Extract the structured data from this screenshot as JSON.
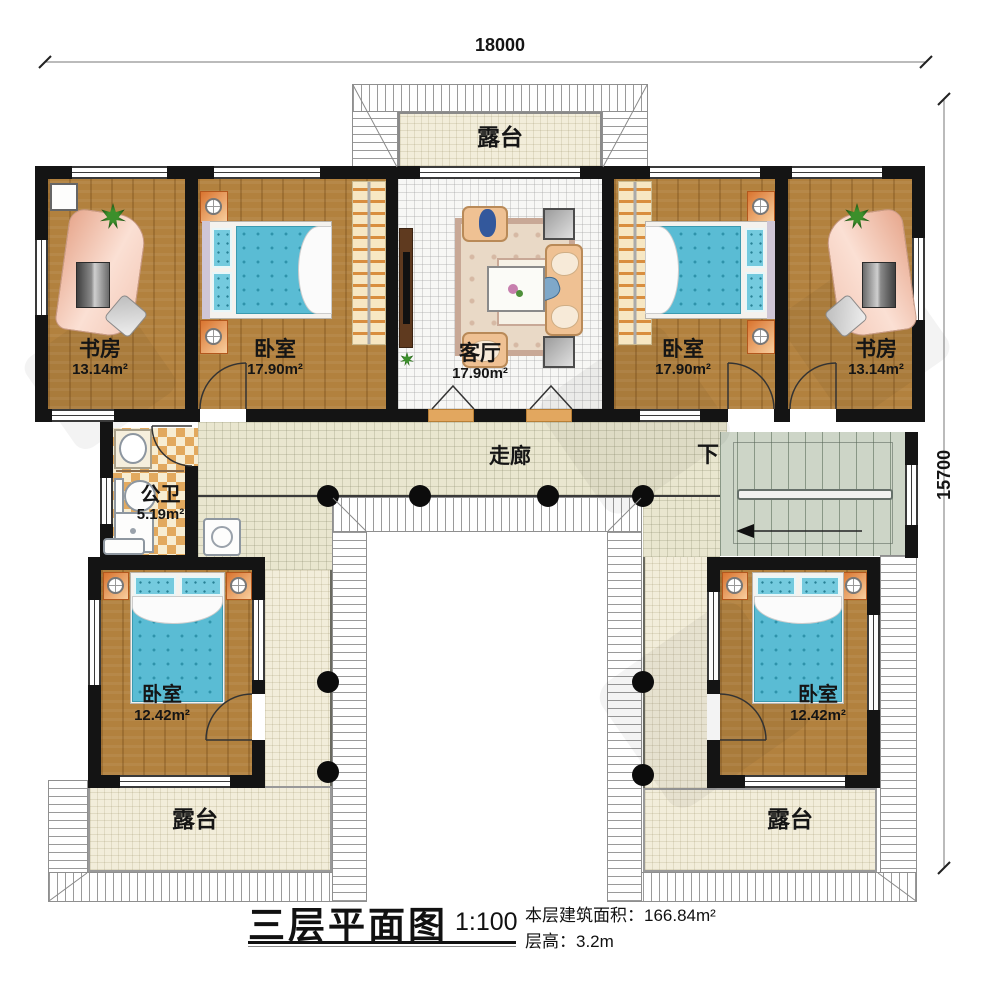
{
  "dimensions": {
    "width_label": "18000",
    "height_label": "15700"
  },
  "rooms": {
    "terrace_top": {
      "name": "露台"
    },
    "study_left": {
      "name": "书房",
      "area": "13.14m²"
    },
    "bedroom_left": {
      "name": "卧室",
      "area": "17.90m²"
    },
    "living_room": {
      "name": "客厅",
      "area": "17.90m²"
    },
    "bedroom_right": {
      "name": "卧室",
      "area": "17.90m²"
    },
    "study_right": {
      "name": "书房",
      "area": "13.14m²"
    },
    "corridor": {
      "name": "走廊"
    },
    "bathroom": {
      "name": "公卫",
      "area": "5.19m²"
    },
    "stairs": {
      "direction_label": "下"
    },
    "bedroom_bottom_left": {
      "name": "卧室",
      "area": "12.42m²"
    },
    "bedroom_bottom_right": {
      "name": "卧室",
      "area": "12.42m²"
    },
    "terrace_bottom_left": {
      "name": "露台"
    },
    "terrace_bottom_right": {
      "name": "露台"
    }
  },
  "title_block": {
    "title": "三层平面图",
    "scale": "1:100",
    "area_label": "本层建筑面积：",
    "area_value": "166.84m²",
    "floor_height_label": "层高：",
    "floor_height_value": "3.2m"
  },
  "colors": {
    "wall": "#141414",
    "wood_floor": "#b2813e",
    "bed_blue": "#5abcd4",
    "terrace_tile": "#f2edda",
    "corridor_tile": "#e9e6cf",
    "stairs_floor": "#cdd5c7",
    "bathroom_tile_accent": "#e2a95e",
    "furniture_accent": "#d9742f"
  }
}
